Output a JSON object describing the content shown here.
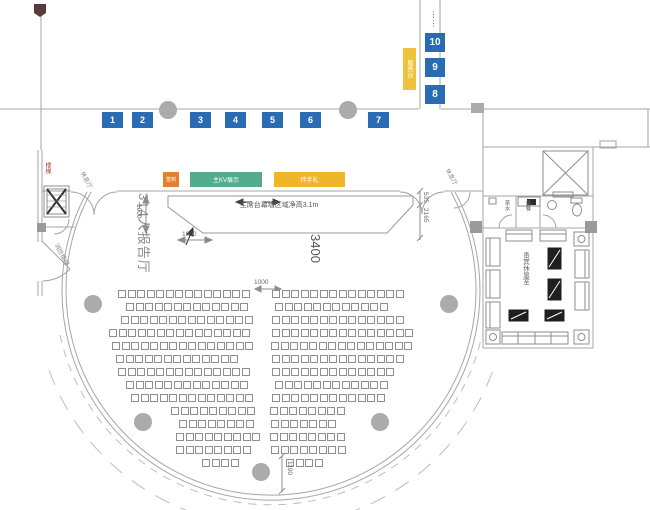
{
  "booths": {
    "top": [
      "1",
      "2",
      "3",
      "4",
      "5",
      "6",
      "7"
    ],
    "right": [
      "8",
      "9",
      "10"
    ]
  },
  "zones": {
    "checkin": "签到",
    "kv": "主KV展示",
    "gift": "伴手礼",
    "service": "服务台"
  },
  "hall": {
    "name": "314人报告厅"
  },
  "stage": {
    "note": "主席台幕墙区域净高3.1m"
  },
  "dims": {
    "stage_left_height": "1000",
    "stage_bottom_width": "1000",
    "aisle_width": "1000",
    "hall_width": "3400",
    "stage_right_upper": "535",
    "stage_right_lower": "2165",
    "bottom_offset": "1190"
  },
  "rooms": {
    "vip_lounge": "贵宾休息室",
    "tea": "茶水",
    "pantry": "备餐",
    "stairwell": "楼梯",
    "fire_stairs": "消防楼梯",
    "rest_hall_left": "休息厅",
    "rest_hall_right": "休息厅"
  },
  "misc": {
    "ellipsis": "⋮⋮"
  },
  "seating": {
    "rows": [
      [
        290,
        118,
        14,
        272,
        14
      ],
      [
        303,
        126,
        13,
        275,
        12
      ],
      [
        316,
        121,
        14,
        272,
        14
      ],
      [
        329,
        109,
        15,
        272,
        15
      ],
      [
        342,
        112,
        15,
        271,
        15
      ],
      [
        355,
        116,
        13,
        272,
        14
      ],
      [
        368,
        118,
        14,
        272,
        13
      ],
      [
        381,
        126,
        13,
        275,
        12
      ],
      [
        394,
        131,
        13,
        272,
        12
      ],
      [
        407,
        171,
        9,
        270,
        8
      ],
      [
        420,
        179,
        8,
        271,
        7
      ],
      [
        433,
        176,
        9,
        270,
        8
      ],
      [
        446,
        176,
        8,
        271,
        8
      ],
      [
        459,
        202,
        4,
        286,
        4
      ]
    ]
  },
  "colors": {
    "booth_blue": "#2a6cb4",
    "zone_orange": "#e2802e",
    "zone_green": "#53ad8c",
    "zone_yellow": "#f0b62a",
    "line_gray": "#a6a6a6"
  }
}
